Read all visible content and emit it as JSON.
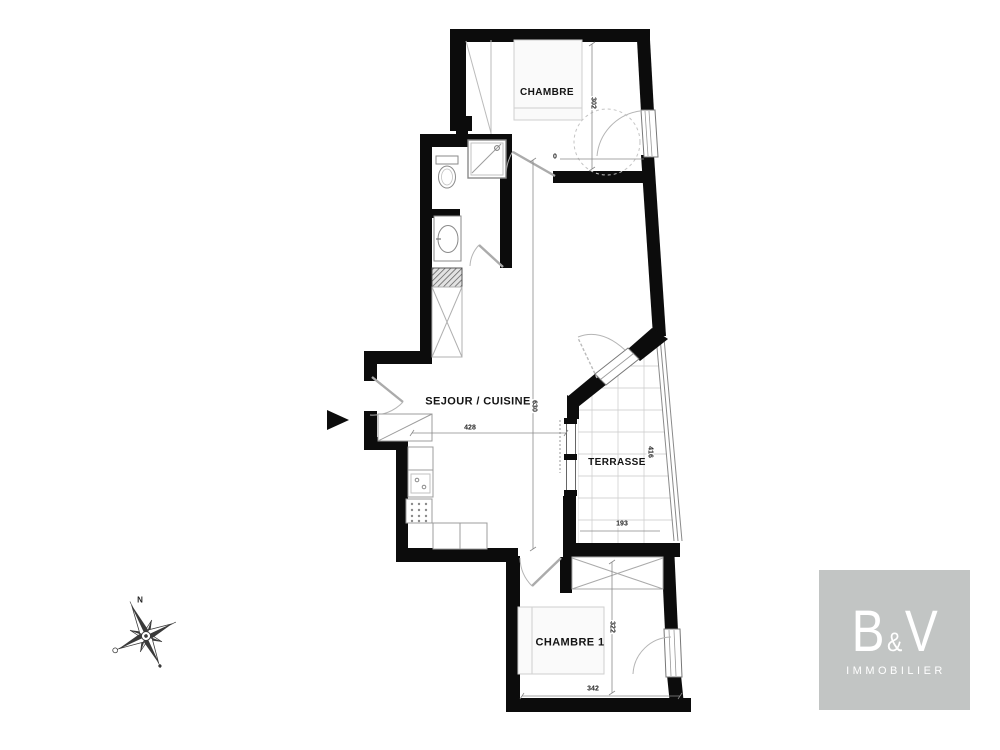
{
  "floorplan": {
    "rooms": [
      {
        "id": "chambre",
        "label": "CHAMBRE"
      },
      {
        "id": "sejour_cuisine",
        "label": "SEJOUR / CUISINE"
      },
      {
        "id": "terrasse",
        "label": "TERRASSE"
      },
      {
        "id": "chambre1",
        "label": "CHAMBRE 1"
      }
    ],
    "dimensions": [
      {
        "id": "chambre_width",
        "value": "302"
      },
      {
        "id": "chambre_door",
        "value": "0"
      },
      {
        "id": "sejour_length",
        "value": "630"
      },
      {
        "id": "sejour_width",
        "value": "428"
      },
      {
        "id": "terrasse_length",
        "value": "416"
      },
      {
        "id": "terrasse_width",
        "value": "193"
      },
      {
        "id": "chambre1_length",
        "value": "322"
      },
      {
        "id": "chambre1_width",
        "value": "342"
      }
    ],
    "colors": {
      "wall": "#0c0c0c",
      "fixture_line": "#9c9c9c",
      "furniture_fill": "#fafafa",
      "grid_line": "#c9c9c9"
    }
  },
  "compass": {
    "north_label": "N"
  },
  "logo": {
    "letter_b": "B",
    "ampersand": "&",
    "letter_v": "V",
    "subtitle": "IMMOBILIER",
    "background": "#c2c5c4",
    "text_color": "#ffffff"
  }
}
